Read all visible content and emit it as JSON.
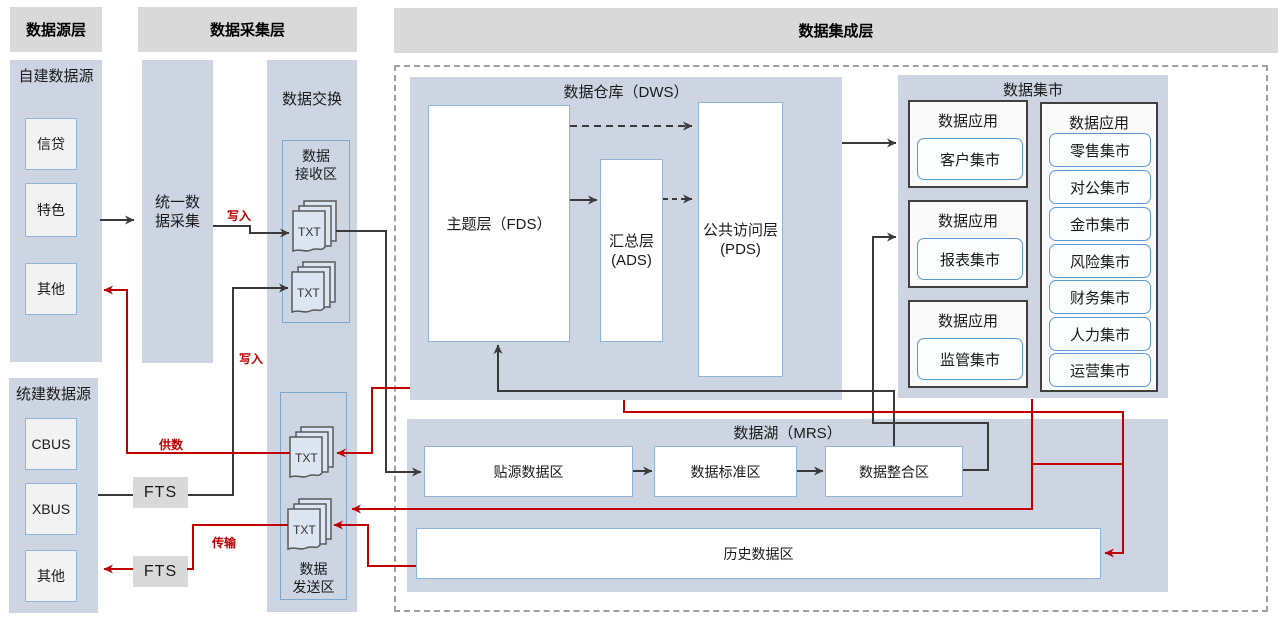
{
  "header_bars": {
    "source": "数据源层",
    "collection": "数据采集层",
    "integration": "数据集成层"
  },
  "source_layer": {
    "self_built": {
      "title": "自建数据源",
      "items": [
        "信贷",
        "特色",
        "其他"
      ]
    },
    "unified": {
      "title": "统建数据源",
      "items": [
        "CBUS",
        "XBUS",
        "其他"
      ]
    }
  },
  "collection_layer": {
    "unified_collection": "统一数\n据采集",
    "fts_upper": "FTS",
    "fts_lower": "FTS"
  },
  "exchange": {
    "title": "数据交换",
    "receive_area": {
      "title": "数据\n接收区",
      "file1": "TXT",
      "file2": "TXT"
    },
    "send_area": {
      "title": "数据\n发送区",
      "file1": "TXT",
      "file2": "TXT"
    }
  },
  "integration": {
    "warehouse": {
      "title": "数据仓库（DWS）",
      "fds": "主题层（FDS）",
      "ads": "汇总层\n(ADS)",
      "pds": "公共访问层\n(PDS)"
    },
    "mart": {
      "title": "数据集市",
      "app1": {
        "title": "数据应用",
        "item": "客户集市"
      },
      "app2": {
        "title": "数据应用",
        "item": "报表集市"
      },
      "app3": {
        "title": "数据应用",
        "item": "监管集市"
      },
      "group": {
        "title": "数据应用",
        "items": [
          "零售集市",
          "对公集市",
          "金市集市",
          "风险集市",
          "财务集市",
          "人力集市",
          "运营集市"
        ]
      }
    },
    "lake": {
      "title": "数据湖（MRS）",
      "zone1": "贴源数据区",
      "zone2": "数据标准区",
      "zone3": "数据整合区",
      "history": "历史数据区"
    }
  },
  "flow_labels": {
    "write": "写入",
    "supply": "供数",
    "transfer": "传输"
  },
  "colors": {
    "panel_blue": "#cdd5e2",
    "bar_gray": "#d9d9d9",
    "box_border_blue": "#8eb4d9",
    "accent_blue": "#5b9bd5",
    "line_black": "#3a3a3a",
    "line_red": "#c00000",
    "box_gray_fill": "#f2f2f2",
    "file_fill": "#dce6f2"
  }
}
